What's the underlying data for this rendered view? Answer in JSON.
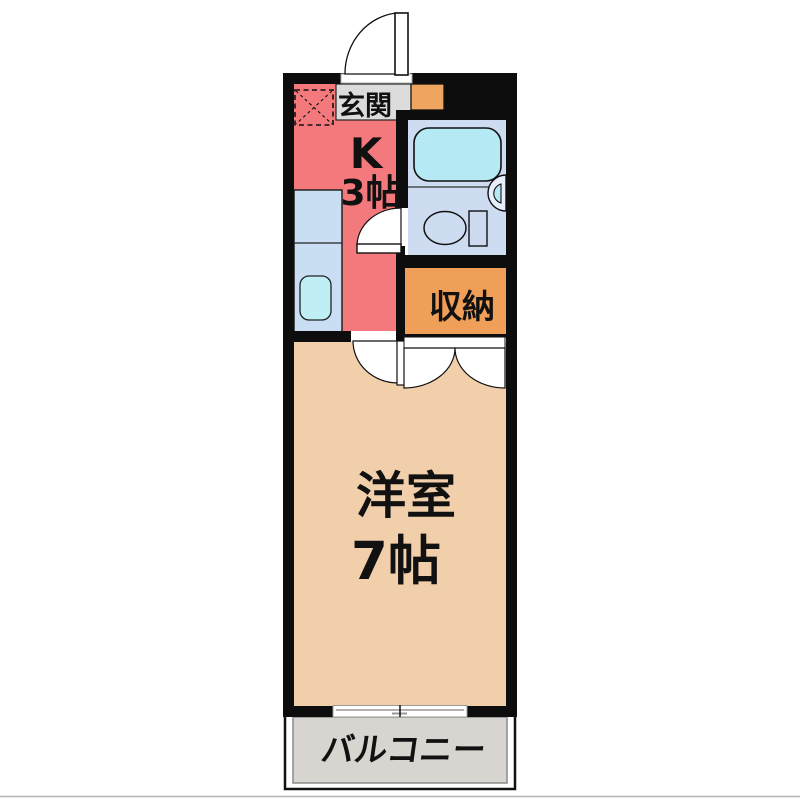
{
  "floorplan": {
    "type_description": "apartment floor plan",
    "rooms": {
      "entrance": {
        "label": "玄関"
      },
      "kitchen": {
        "label": "K",
        "size": "3帖"
      },
      "closet": {
        "label": "収納"
      },
      "western_room": {
        "label": "洋室",
        "size": "7帖"
      },
      "balcony": {
        "label": "バルコニー"
      }
    },
    "colors": {
      "wall": "#0d0d0d",
      "kitchen": "#f4797d",
      "room": "#f2cfab",
      "closet": "#ef9f58",
      "shoe_cabinet": "#efa55f",
      "bathroom": "#cddcf0",
      "bathtub": "#b5e9f3",
      "counter": "#c9def2",
      "counter_sink": "#bfeef5",
      "entrance_floor": "#dcdcdc",
      "balcony_floor": "#d8d4d0",
      "toilet_tank": "#ccd9ee",
      "wash_basin_outer": "#e7eefb",
      "wash_basin_inner": "#b8e8f4",
      "door_leaf": "#ffffff",
      "text": "#111111"
    }
  }
}
